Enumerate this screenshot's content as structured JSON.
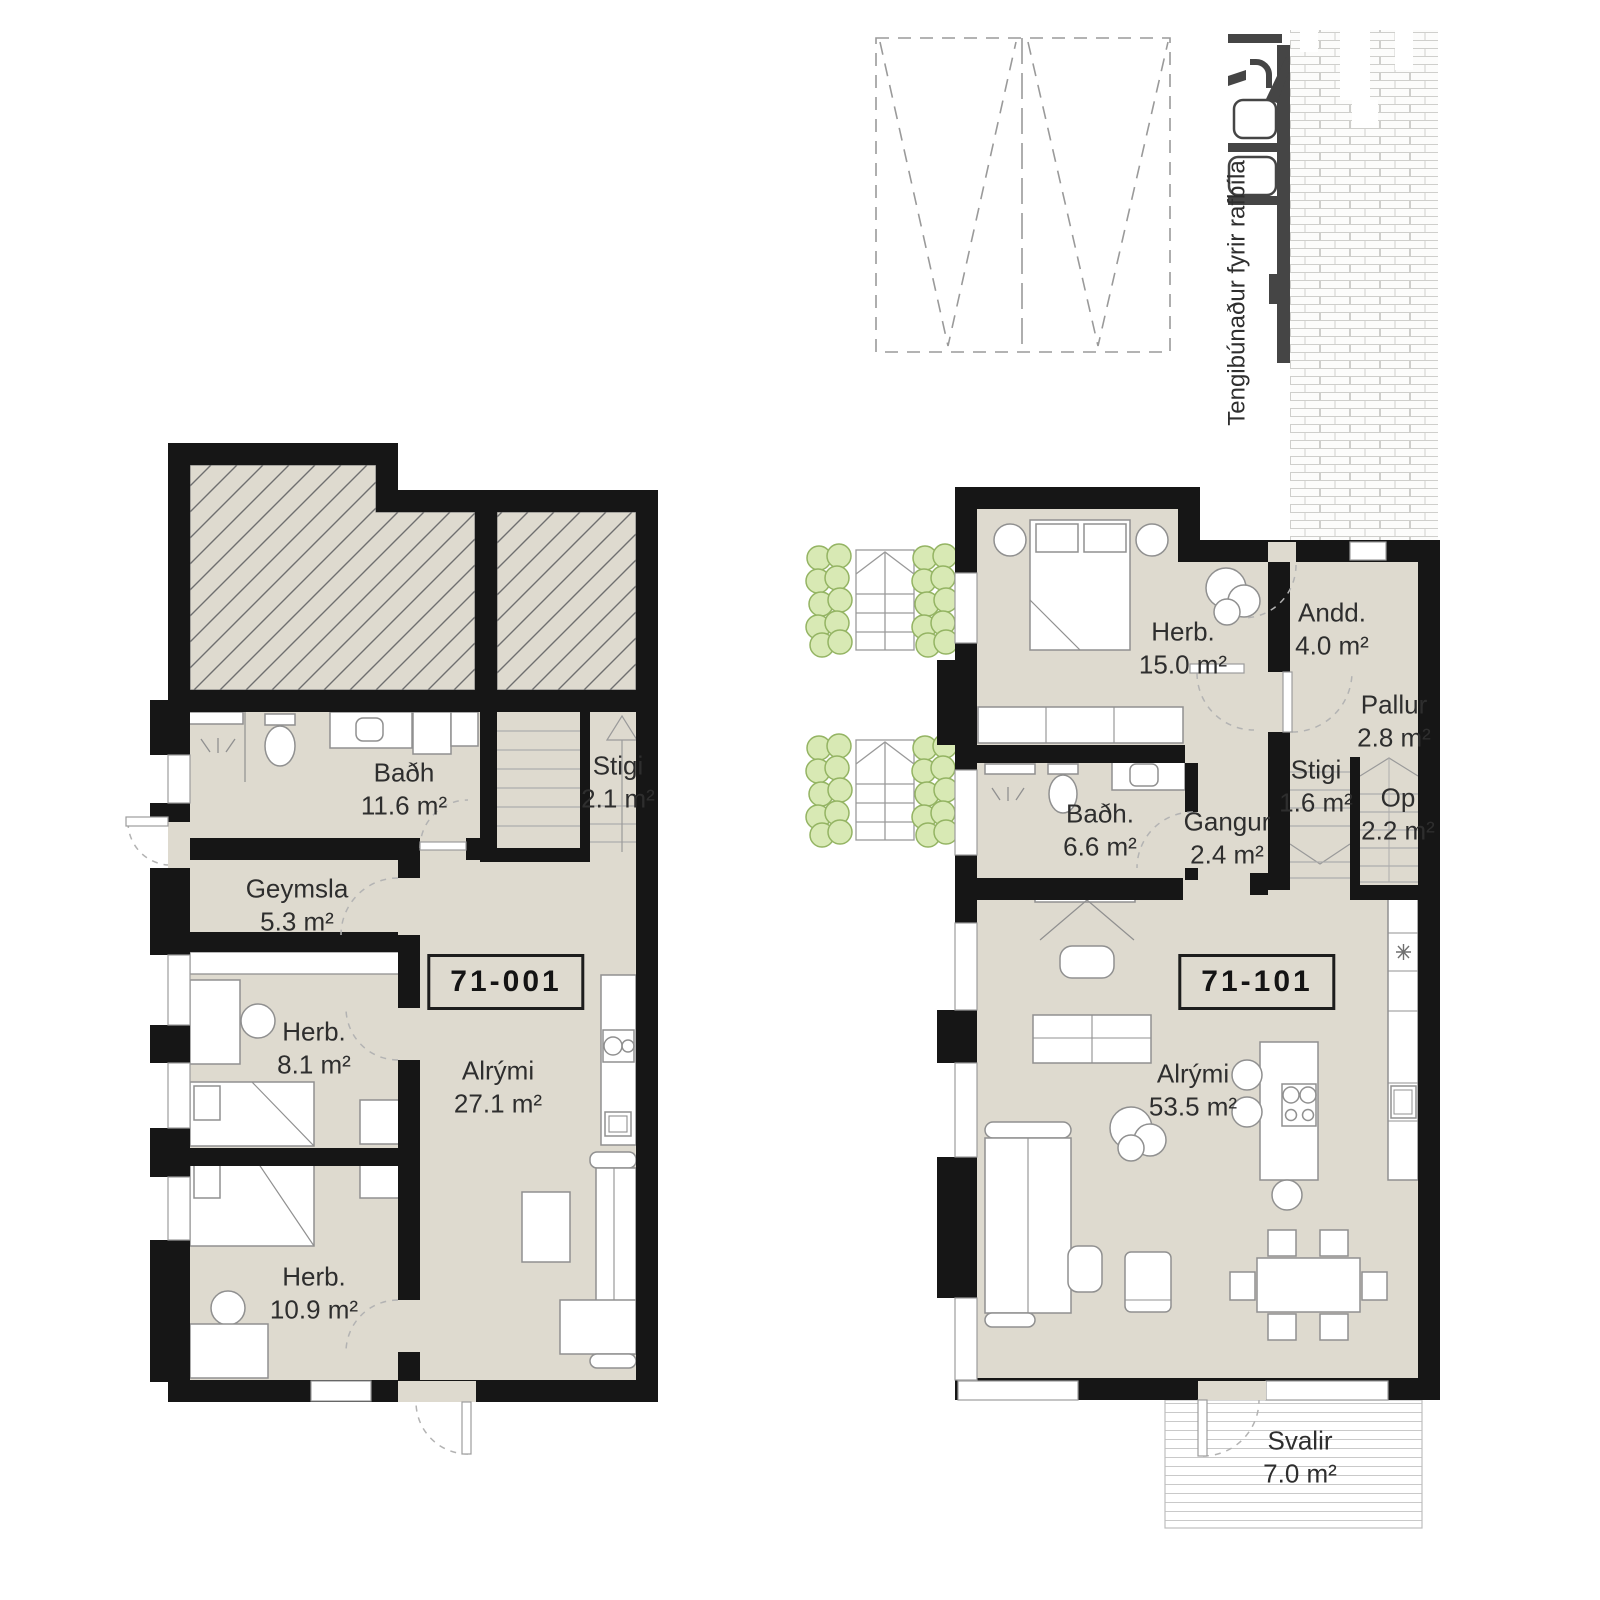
{
  "document": {
    "type": "architectural floor plans",
    "units_shown": 2
  },
  "site": {
    "ev_line1": "Tengibúnaður",
    "ev_line2": "fyrir rafbíla",
    "parking_spaces": 2
  },
  "plans": {
    "left": {
      "unit_id": "71-001",
      "rooms": [
        {
          "name": "Baðh",
          "area": "11.6 m²"
        },
        {
          "name": "Stigi",
          "area": "2.1 m²"
        },
        {
          "name": "Geymsla",
          "area": "5.3 m²"
        },
        {
          "name": "Herb.",
          "area": "8.1 m²"
        },
        {
          "name": "Alrými",
          "area": "27.1 m²"
        },
        {
          "name": "Herb.",
          "area": "10.9 m²"
        }
      ]
    },
    "right": {
      "unit_id": "71-101",
      "rooms": [
        {
          "name": "Herb.",
          "area": "15.0 m²"
        },
        {
          "name": "Andd.",
          "area": "4.0 m²"
        },
        {
          "name": "Pallur",
          "area": "2.8 m²"
        },
        {
          "name": "Stigi",
          "area": "1.6 m²"
        },
        {
          "name": "Op",
          "area": "2.2 m²"
        },
        {
          "name": "Baðh.",
          "area": "6.6 m²"
        },
        {
          "name": "Gangur",
          "area": "2.4 m²"
        },
        {
          "name": "Alrými",
          "area": "53.5 m²"
        },
        {
          "name": "Svalir",
          "area": "7.0 m²"
        }
      ]
    }
  },
  "colors": {
    "floor": "#dedacf",
    "wall": "#161616",
    "hatch_line": "#6f6f6f",
    "furniture_line": "#8f8f8f",
    "bush_fill": "#d8e9b4",
    "bush_stroke": "#94b463",
    "brick_line": "#cfcfcc",
    "ev_dark": "#454545"
  }
}
